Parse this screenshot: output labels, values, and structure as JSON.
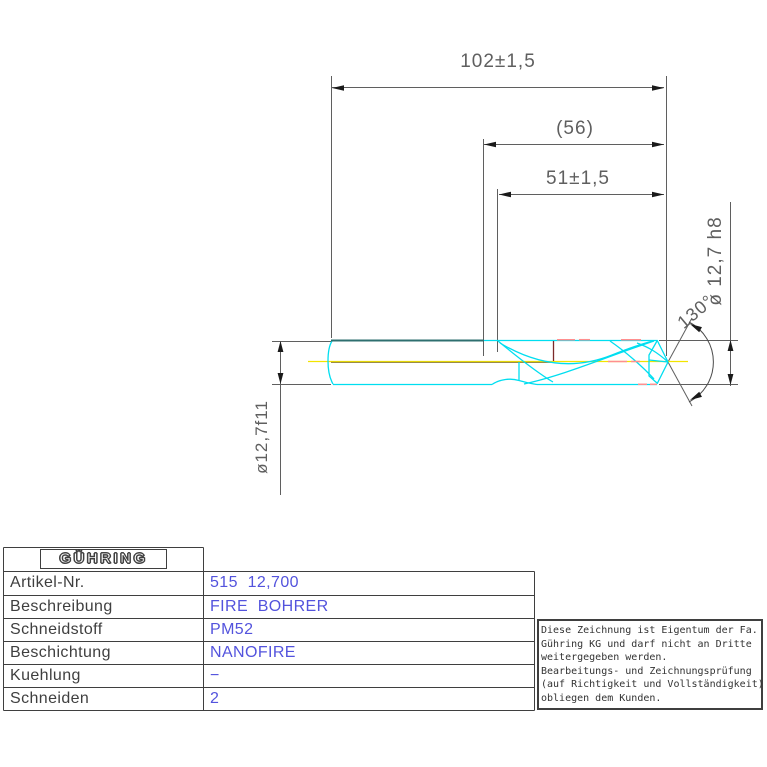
{
  "drawing": {
    "dims": {
      "overall_length": "102±1,5",
      "ref_length": "(56)",
      "flute_length": "51±1,5",
      "cut_dia": "ø 12,7 h8",
      "shank_dia": "ø12,7f11",
      "point_angle": "130°"
    },
    "colors": {
      "outline_cyan": "#00def0",
      "shank_teal": "#2e6f6f",
      "centerline_yellow": "#f2e400",
      "margin_red": "#ff8f8f",
      "dark_red": "#7c2a2a",
      "dim_gray": "#5f5f5f",
      "value_blue": "#5353dd"
    }
  },
  "title_block": {
    "logo": "GÜHRING",
    "rows": [
      {
        "label": "Artikel-Nr.",
        "value": "515  12,700"
      },
      {
        "label": "Beschreibung",
        "value": "FIRE  BOHRER"
      },
      {
        "label": "Schneidstoff",
        "value": "PM52"
      },
      {
        "label": "Beschichtung",
        "value": "NANOFIRE"
      },
      {
        "label": "Kuehlung",
        "value": "−"
      },
      {
        "label": "Schneiden",
        "value": "2"
      }
    ]
  },
  "notes": {
    "lines": [
      "Diese Zeichnung ist Eigentum der Fa.",
      "Gühring KG und darf nicht an Dritte",
      "weitergegeben werden.",
      "Bearbeitungs- und Zeichnungsprüfung",
      "(auf Richtigkeit und Vollständigkeit)",
      "obliegen dem Kunden."
    ]
  }
}
